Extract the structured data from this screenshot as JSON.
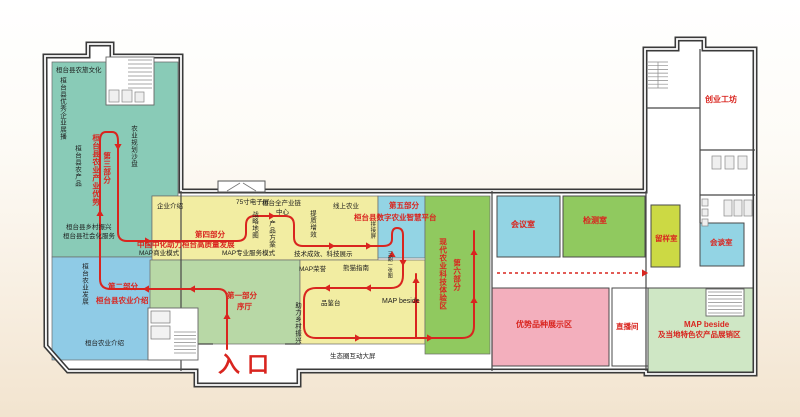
{
  "colors": {
    "wall": "#3a3a3a",
    "teal": "#89cbb7",
    "blue": "#8fcbe6",
    "sage": "#b8d8a6",
    "yellow": "#f2eda2",
    "cyan": "#93d4e4",
    "green": "#90c95f",
    "pink": "#f3afbd",
    "lime": "#ccd944",
    "pale_green": "#cfe7c5",
    "route": "#d9251f"
  },
  "plan": {
    "entrance": "入口",
    "parts": {
      "p1": {
        "num": "第一部分",
        "name": "序厅"
      },
      "p2": {
        "num": "第二部分",
        "name": "桓台县农业介绍"
      },
      "p3": {
        "num": "第三部分",
        "name": "桓台县农业产业优势"
      },
      "p4": {
        "num": "第四部分",
        "name": "中国中化助力桓台高质量发展"
      },
      "p5": {
        "num": "第五部分",
        "name": "桓台县数字农业智慧平台"
      },
      "p6": {
        "num": "第六部分",
        "name": "现代农业科技体验区"
      }
    },
    "rooms": {
      "meeting": "会议室",
      "testing": "检测室",
      "sample": "留样室",
      "talk": "会谈室",
      "advantage": "优势品种展示区",
      "live": "直播间",
      "map_beside_line1": "MAP beside",
      "map_beside_line2": "及当地特色农产品展销区",
      "startup": "创业工坊"
    },
    "areas": {
      "agritourism": "桓台县农旅文化",
      "excellent": "桓台县优秀企业展播",
      "sandtable": "农业规划沙盘",
      "products": "桓台县农产品",
      "revitalization": "桓台县乡村振兴",
      "social": "桓台县社会化服务",
      "development": "桓台农业发展",
      "agri_intro": "桓台农业介绍",
      "enterprise": "企业介绍",
      "screen75": "75寸电子屏",
      "strategy": "战略地图",
      "chain": "桓台全产业链",
      "chain_center": "中心",
      "quality": "提质增效",
      "online": "线上农业",
      "product": "产品方案",
      "map_business": "MAP商业模式",
      "map_pro": "MAP专业服务模式",
      "tech": "技术成效、科技展示",
      "honor": "MAP荣誉",
      "panda": "熊猫指南",
      "tasting": "品鉴台",
      "map_beside": "MAP beside",
      "help": "助力乡村振兴",
      "eco": "生态圈互动大屏",
      "splice": "拼接屏",
      "one_map": "三期一张图"
    }
  }
}
